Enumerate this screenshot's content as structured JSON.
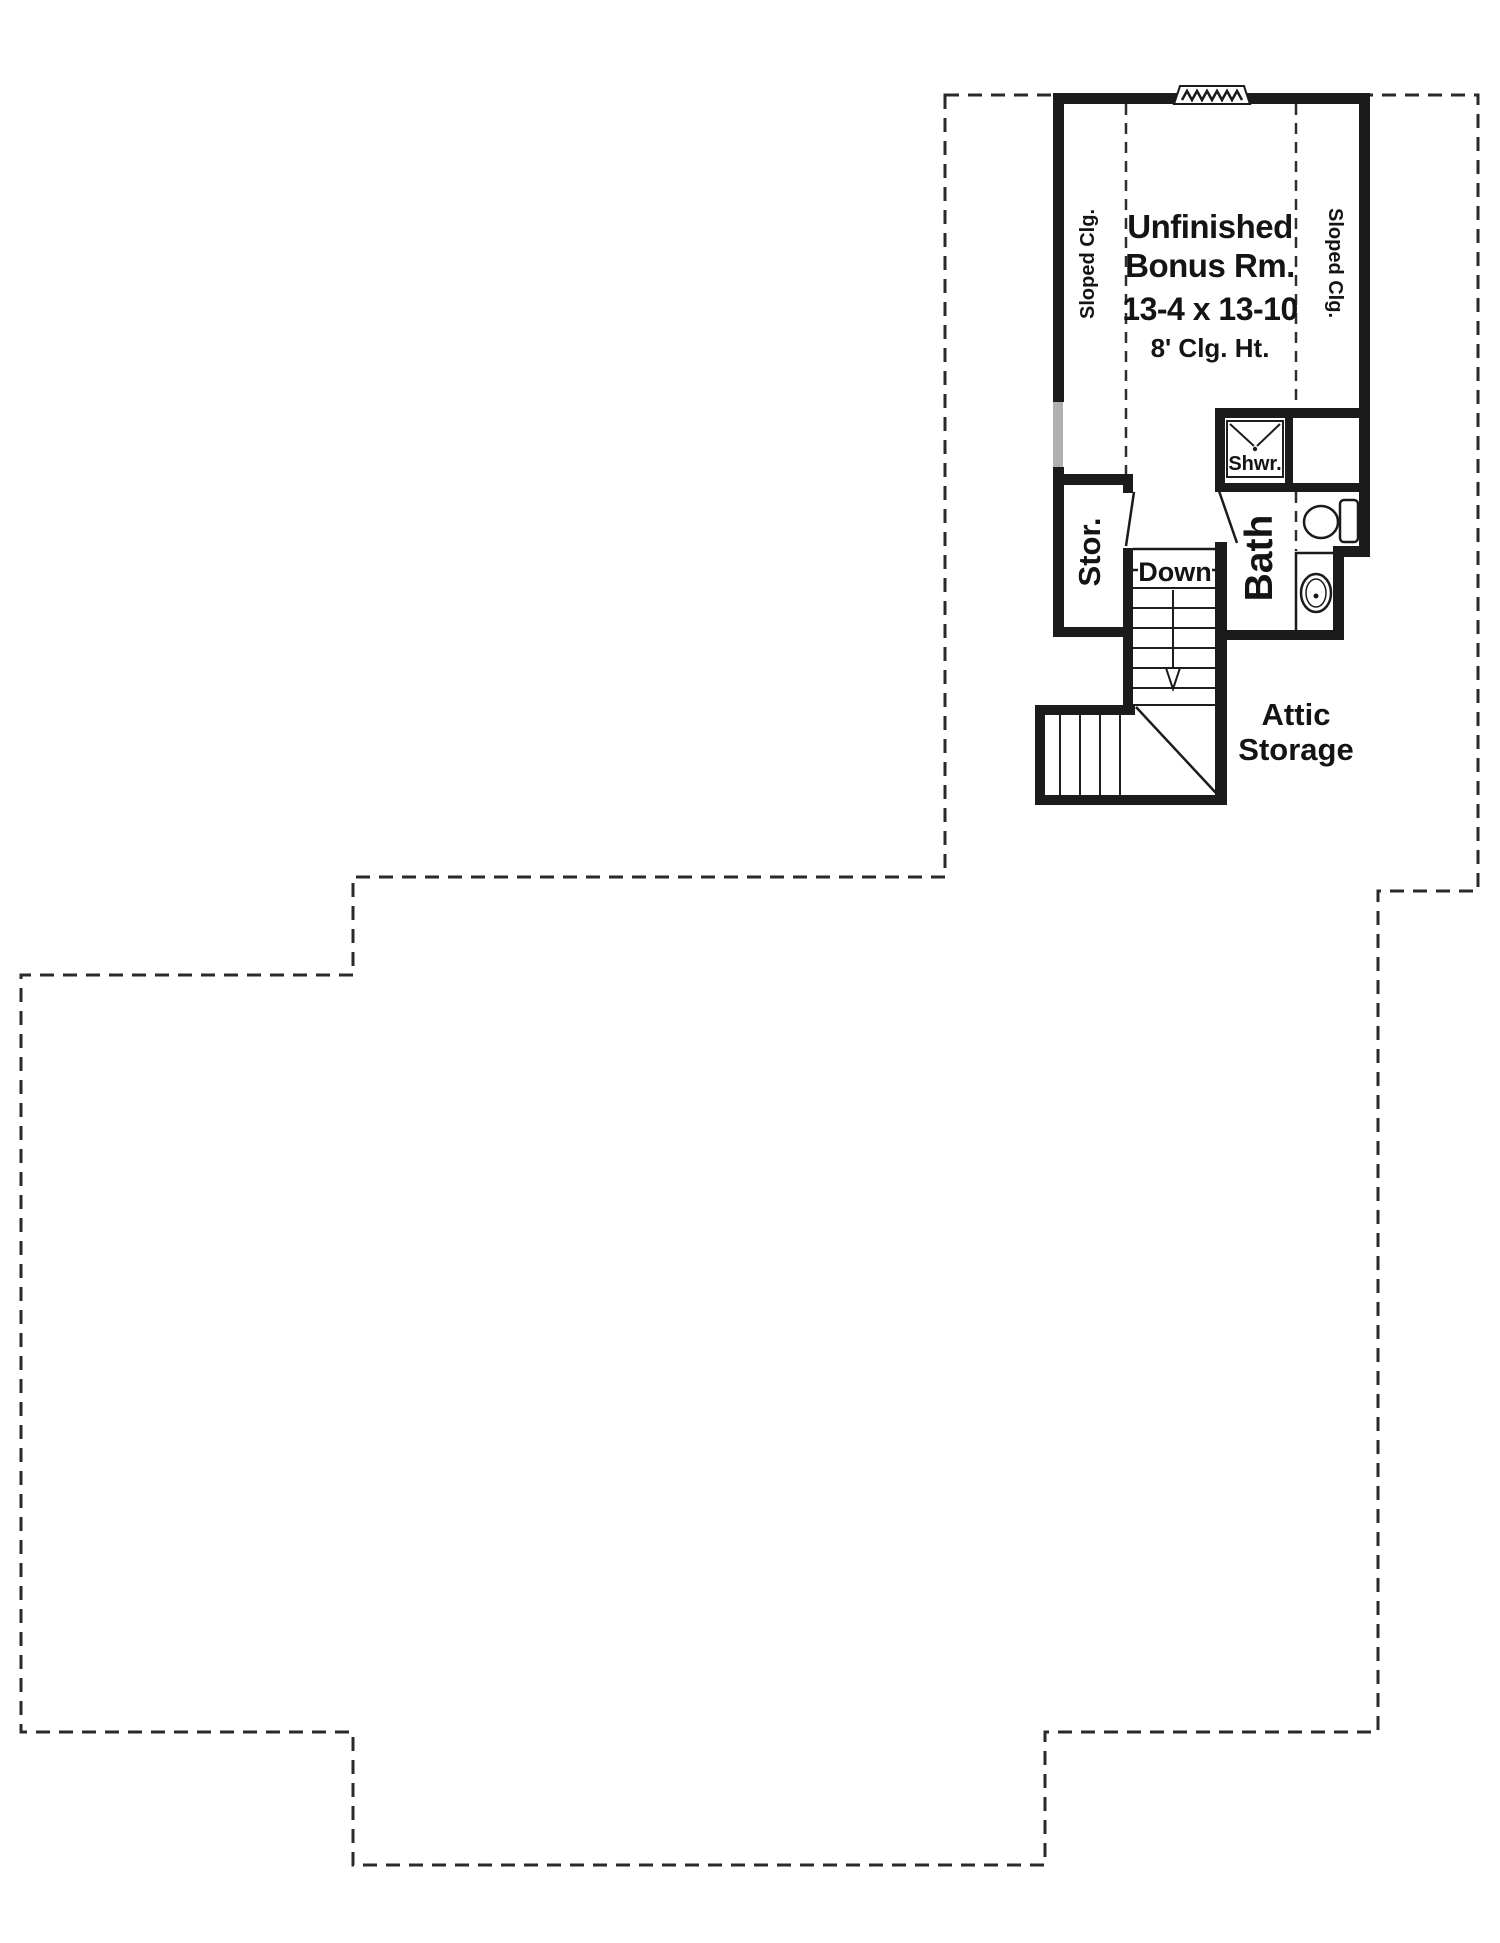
{
  "plan": {
    "bonus_room": {
      "name_line1": "Unfinished",
      "name_line2": "Bonus Rm.",
      "dimensions": "13-4 x 13-10",
      "ceiling_height": "8' Clg. Ht.",
      "sloped_ceiling_left": "Sloped Clg.",
      "sloped_ceiling_right": "Sloped Clg."
    },
    "rooms": {
      "storage_label": "Stor.",
      "bath_label": "Bath",
      "shower_label": "Shwr.",
      "attic_label_line1": "Attic",
      "attic_label_line2": "Storage"
    },
    "stairs": {
      "down_label": "Down"
    }
  },
  "colors": {
    "wall": "#1b1b1b",
    "dashed_outline": "#2a2a2a",
    "window_gray": "#b0b0b0",
    "background": "#ffffff",
    "text": "#141414"
  }
}
